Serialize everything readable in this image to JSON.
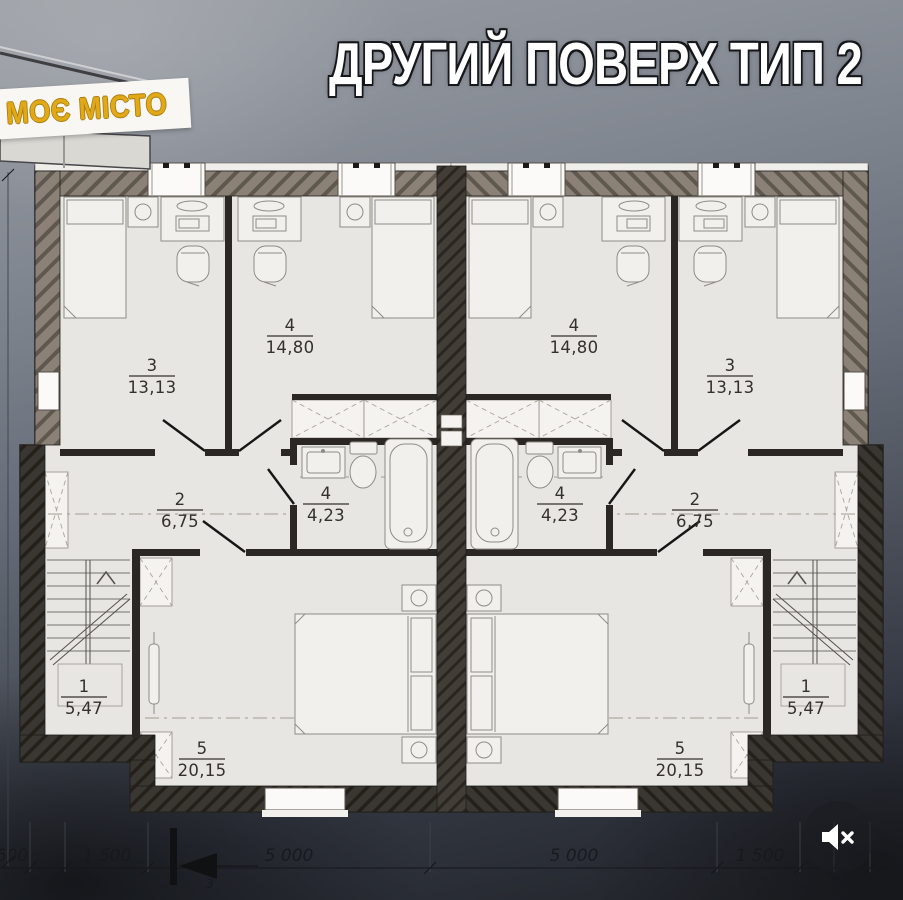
{
  "header": {
    "brand": "МОЄ МІСТО",
    "title": "ДРУГИЙ ПОВЕРХ ТИП 2"
  },
  "plan": {
    "rooms": [
      {
        "id": "left-stairs",
        "number": "1",
        "area": "5,47"
      },
      {
        "id": "left-hall",
        "number": "2",
        "area": "6,75"
      },
      {
        "id": "left-bedroom",
        "number": "3",
        "area": "13,13"
      },
      {
        "id": "left-bedroom-2",
        "number": "4",
        "area": "14,80"
      },
      {
        "id": "left-bathroom",
        "number": "4",
        "area": "4,23"
      },
      {
        "id": "left-master",
        "number": "5",
        "area": "20,15"
      },
      {
        "id": "right-bedroom-2",
        "number": "4",
        "area": "14,80"
      },
      {
        "id": "right-bedroom",
        "number": "3",
        "area": "13,13"
      },
      {
        "id": "right-bathroom",
        "number": "4",
        "area": "4,23"
      },
      {
        "id": "right-hall",
        "number": "2",
        "area": "6,75"
      },
      {
        "id": "right-stairs",
        "number": "1",
        "area": "5,47"
      },
      {
        "id": "right-master",
        "number": "5",
        "area": "20,15"
      }
    ],
    "dimensions": [
      "600",
      "1 500",
      "5 000",
      "5 000",
      "1 500",
      "600"
    ],
    "section_mark": "3"
  },
  "media": {
    "mute_icon": "speaker-muted"
  },
  "colors": {
    "brand_yellow": "#e2a917",
    "banner_white": "#f8f7f3",
    "plan_floor": "#e7e6e3",
    "wall_top": "#8b8177",
    "wall_dark": "#3a3733",
    "title_white": "#ffffff"
  }
}
